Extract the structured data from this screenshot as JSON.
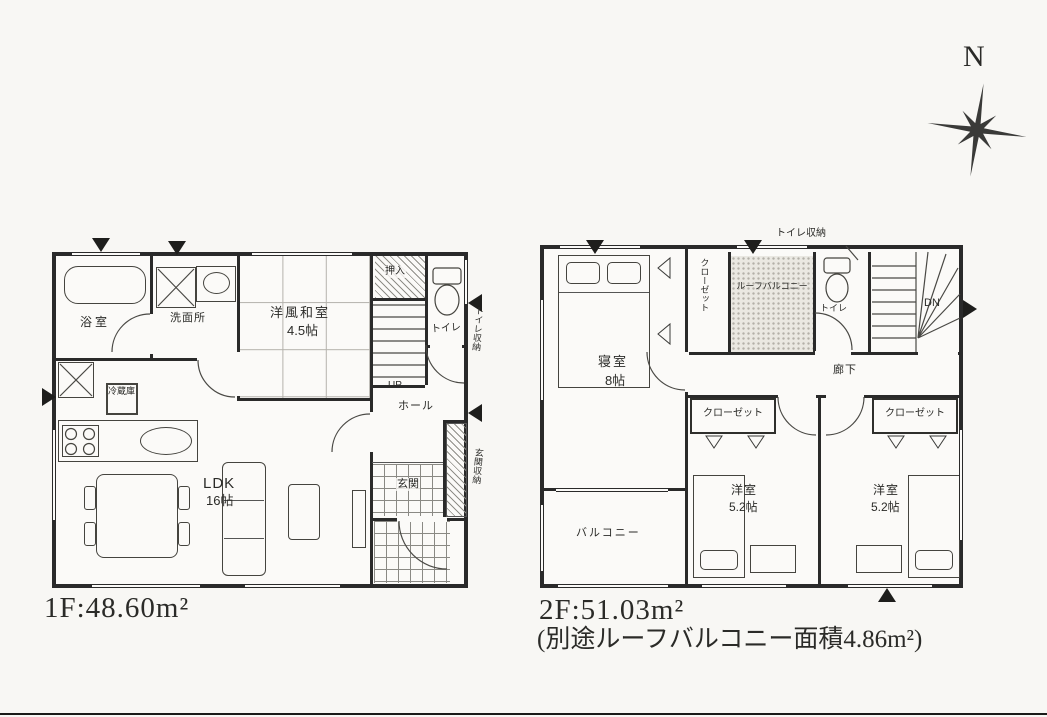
{
  "colors": {
    "wall": "#2a2a2a",
    "paper": "#f8f7f4",
    "room": "#fbfaf8"
  },
  "compass": {
    "label": "N"
  },
  "floor1": {
    "caption": "1F:48.60m²",
    "labels": {
      "bath": "浴室",
      "washroom": "洗面所",
      "washitsu_name": "洋風和室",
      "washitsu_size": "4.5帖",
      "oshiire": "押入",
      "toilet": "トイレ",
      "stairs": "UP",
      "hall": "ホール",
      "entrance": "玄関",
      "ldk_name": "LDK",
      "ldk_size": "16帖",
      "refrigerator": "冷蔵庫",
      "toilet_storage": "トイレ収納",
      "entrance_storage": "玄関収納"
    }
  },
  "floor2": {
    "caption": "2F:51.03m²",
    "note": "(別途ルーフバルコニー面積4.86m²)",
    "labels": {
      "bedroom_name": "寝室",
      "bedroom_size": "8帖",
      "closet_side": "クローゼット",
      "roof_balcony": "ルーフバルコニー",
      "toilet": "トイレ",
      "stairs": "DN",
      "hallway": "廊下",
      "closet_left": "クローゼット",
      "closet_right": "クローゼット",
      "west_left_name": "洋室",
      "west_left_size": "5.2帖",
      "west_right_name": "洋室",
      "west_right_size": "5.2帖",
      "balcony": "バルコニー",
      "toilet_storage": "トイレ収納"
    }
  }
}
